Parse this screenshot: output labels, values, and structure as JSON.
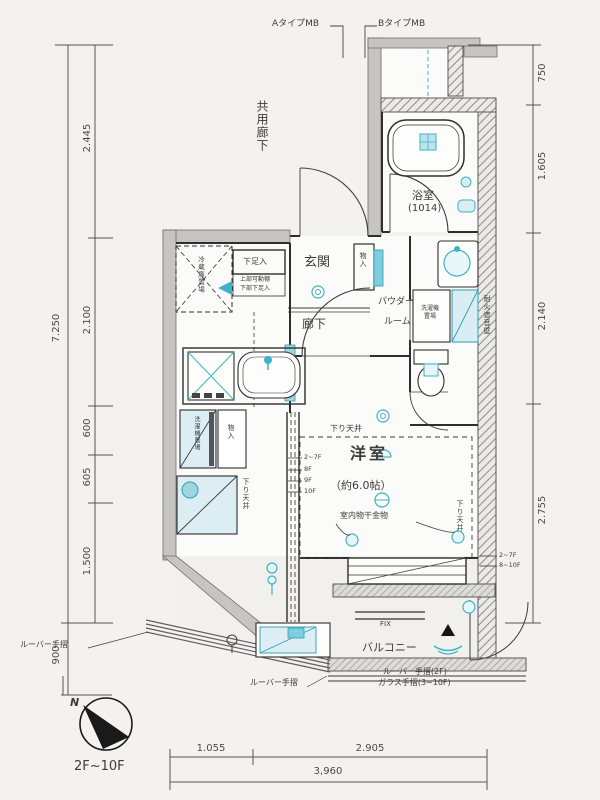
{
  "labels": {
    "type_a_mb": "AタイプMB",
    "type_b_mb": "BタイプMB",
    "common_corridor": "共用廊下",
    "bathroom": "浴室",
    "bathroom_size": "(1014)",
    "entrance": "玄関",
    "shoe_cabinet": "下足入",
    "shoe_note_1": "上部可動棚",
    "shoe_note_2": "下部下足入",
    "refrigerator": "冷蔵庫置場",
    "hallway": "廊下",
    "powder_1": "パウダー",
    "powder_2": "ルーム",
    "washer_1": "洗濯機",
    "washer_2": "置場",
    "washing_machine_v": "洗濯機置場",
    "storage": "物入",
    "storage_entrance": "物入",
    "western_room": "洋室",
    "western_room_size": "（約6.0帖）",
    "indoor_drying_note": "室内物干金物",
    "dropped_ceiling": "下り天井",
    "balcony": "バルコニー",
    "louver_rail": "ルーバー手摺",
    "rail_note_1": "ルーバー手摺(2F)",
    "rail_note_2": "ガラス手摺(3~10F)",
    "fix_window": "FIX",
    "fire_wall": "耐火遮音壁"
  },
  "floor_marks": {
    "left": [
      "2~7F",
      "8F",
      "9F",
      "10F"
    ],
    "right": [
      "2~7F",
      "8~10F"
    ]
  },
  "dims": {
    "left": [
      "2.445",
      "2.100",
      "600",
      "605",
      "1.500"
    ],
    "left_total": "7.250",
    "left_bottom": "900",
    "right": [
      "750",
      "1.605",
      "2.140",
      "2.755"
    ],
    "bottom": [
      "1.055",
      "2.905"
    ],
    "bottom_total": "3,960"
  },
  "compass": {
    "north": "N",
    "floor_range": "2F~10F"
  },
  "colors": {
    "accent_teal": "#3fb3c5",
    "teal_fill": "#d9edf3",
    "wall_gray": "#c6c5c1",
    "line_dark": "#2e2e2e"
  }
}
